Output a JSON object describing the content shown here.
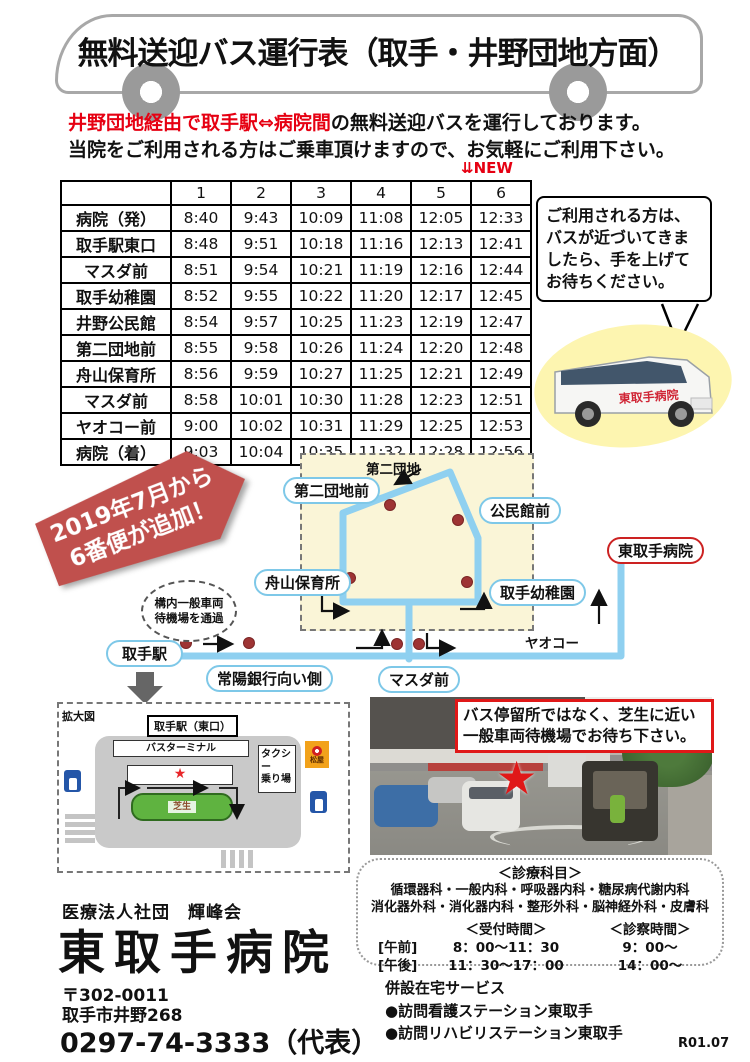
{
  "colors": {
    "accent_red": "#e60012",
    "banner_red": "#c0504d",
    "route_blue": "#8fd0f0",
    "label_border_blue": "#7ec8e8",
    "cream": "#faf5d7",
    "dot_red": "#9e3434",
    "hospital_red": "#cc2222",
    "lawn_green": "#5fb340"
  },
  "title": {
    "text": "無料送迎バス運行表（取手・井野団地方面）"
  },
  "intro": {
    "line1_red": "井野団地経由で取手駅⇔病院間",
    "line1_rest": "の無料送迎バスを運行しております。",
    "line2": "当院をご利用される方はご乗車頂けますので、お気軽にご利用下さい。"
  },
  "timetable": {
    "new_marker": "⇊NEW",
    "columns": [
      "1",
      "2",
      "3",
      "4",
      "5",
      "6"
    ],
    "rows": [
      {
        "stop": "病院（発）",
        "times": [
          "8:40",
          "9:43",
          "10:09",
          "11:08",
          "12:05",
          "12:33"
        ]
      },
      {
        "stop": "取手駅東口",
        "times": [
          "8:48",
          "9:51",
          "10:18",
          "11:16",
          "12:13",
          "12:41"
        ]
      },
      {
        "stop": "マスダ前",
        "times": [
          "8:51",
          "9:54",
          "10:21",
          "11:19",
          "12:16",
          "12:44"
        ]
      },
      {
        "stop": "取手幼稚園",
        "times": [
          "8:52",
          "9:55",
          "10:22",
          "11:20",
          "12:17",
          "12:45"
        ]
      },
      {
        "stop": "井野公民館",
        "times": [
          "8:54",
          "9:57",
          "10:25",
          "11:23",
          "12:19",
          "12:47"
        ]
      },
      {
        "stop": "第二団地前",
        "times": [
          "8:55",
          "9:58",
          "10:26",
          "11:24",
          "12:20",
          "12:48"
        ]
      },
      {
        "stop": "舟山保育所",
        "times": [
          "8:56",
          "9:59",
          "10:27",
          "11:25",
          "12:21",
          "12:49"
        ]
      },
      {
        "stop": "マスダ前",
        "times": [
          "8:58",
          "10:01",
          "10:30",
          "11:28",
          "12:23",
          "12:51"
        ]
      },
      {
        "stop": "ヤオコー前",
        "times": [
          "9:00",
          "10:02",
          "10:31",
          "11:29",
          "12:25",
          "12:53"
        ]
      },
      {
        "stop": "病院（着）",
        "times": [
          "9:03",
          "10:04",
          "10:35",
          "11:32",
          "12:28",
          "12:56"
        ]
      }
    ]
  },
  "hail_note": {
    "text": "ご利用される方は、バスが近づいてきましたら、手を上げてお待ちください。"
  },
  "van": {
    "side_text": "東取手病院"
  },
  "banner": {
    "line1": "2019年7月から",
    "line2": "6番便が追加！"
  },
  "map": {
    "labels": {
      "daini_danchi_mae": "第二団地前",
      "kominkan_mae": "公民館前",
      "funayama_hoikusho": "舟山保育所",
      "toride_yochien": "取手幼稚園",
      "hospital": "東取手病院",
      "toride_station": "取手駅",
      "joyo_bank": "常陽銀行向い側",
      "masuda_mae": "マスダ前",
      "yaoko": "ヤオコー",
      "daini_danchi": "第二団地"
    },
    "wait_note_line1": "構内一般車両",
    "wait_note_line2": "待機場を通過"
  },
  "station_diagram": {
    "zoom_label": "拡大図",
    "station": "取手駅（東口）",
    "bus_terminal": "バスターミナル",
    "star": "★",
    "lawn": "芝生",
    "taxi_line1": "タクシー",
    "taxi_line2": "乗り場",
    "matsuya": "松屋"
  },
  "photo": {
    "star": "★",
    "note_line1": "バス停留所ではなく、芝生に近い",
    "note_line2": "一般車両待機場でお待ち下さい。"
  },
  "hospital": {
    "org": "医療法人社団　輝峰会",
    "name": "東取手病院",
    "postal": "〒302-0011",
    "address": "取手市井野268",
    "phone": "0297-74-3333（代表）"
  },
  "clinic": {
    "dept_title": "＜診療科目＞",
    "departments": [
      "循環器科・一般内科・呼吸器内科・糖尿病代謝内科",
      "消化器外科・消化器内科・整形外科・脳神経外科・皮膚科"
    ],
    "reception_title": "＜受付時間＞",
    "exam_title": "＜診察時間＞",
    "hours": [
      {
        "label": "[午前]",
        "reception": "8：00～11：30",
        "exam": "9：00～"
      },
      {
        "label": "[午後]",
        "reception": "11：30～17：00",
        "exam": "14：00～"
      }
    ]
  },
  "home_services": {
    "title": "併設在宅サービス",
    "items": [
      "●訪問看護ステーション東取手",
      "●訪問リハビリステーション東取手"
    ]
  },
  "version": "R01.07"
}
